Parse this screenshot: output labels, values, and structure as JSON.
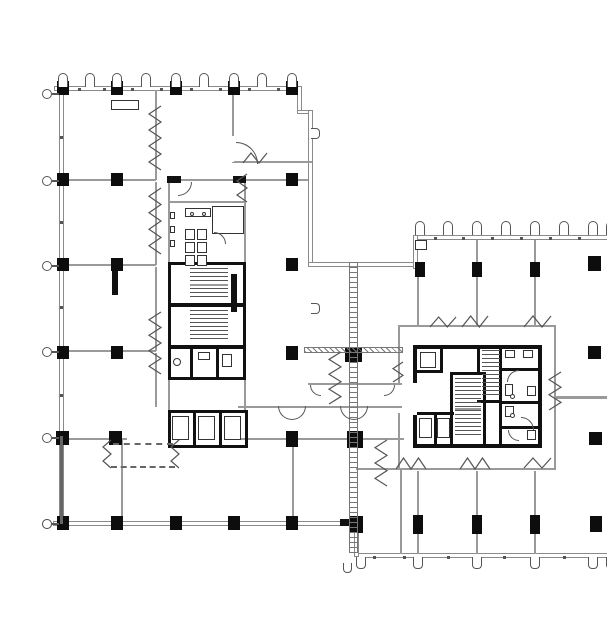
{
  "drawing": {
    "kind": "architectural floor plan",
    "caption": "Typical floor plan — two offset rectangular office wings joined by an expansion-joint link, each with a central service core",
    "left_wing_core": [
      "toilet room with six stalls and urinals",
      "two scissor stairs",
      "small washroom",
      "bank of three elevators"
    ],
    "right_wing_core": [
      "two stairs",
      "three elevators",
      "washroom block",
      "corridor ring with break symbols"
    ],
    "perimeter": [
      "window mullion ticks on all exterior walls",
      "structural column grid"
    ]
  },
  "legend": {
    "background": "#ffffff",
    "exterior_wall": "#8a8a8a",
    "interior_wall": "#9a9a9a",
    "core_wall": "#111111",
    "column": "#0d0d0d",
    "symbol": "#555555",
    "joint": "#777777"
  }
}
